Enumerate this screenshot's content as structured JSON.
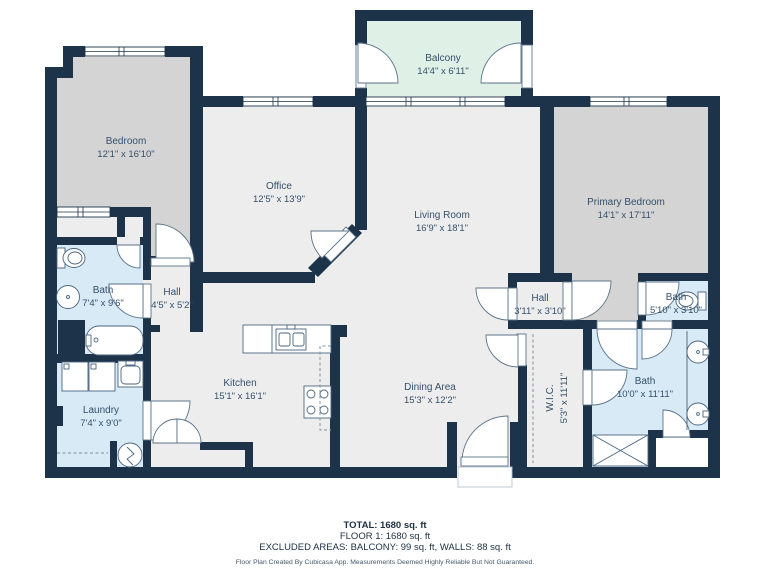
{
  "title": "Floor plan",
  "colors": {
    "wall": "#1d3349",
    "floor": "#ededed",
    "bedroom_floor": "#d4d4d4",
    "bath_floor": "#d7eaf6",
    "balcony_floor": "#dff1e6",
    "label_text": "#35506b"
  },
  "rooms": {
    "balcony": {
      "name": "Balcony",
      "dims": "14'4\" x 6'11\""
    },
    "bedroom": {
      "name": "Bedroom",
      "dims": "12'1\" x 16'10\""
    },
    "office": {
      "name": "Office",
      "dims": "12'5\" x 13'9\""
    },
    "living": {
      "name": "Living Room",
      "dims": "16'9\" x 18'1\""
    },
    "primary": {
      "name": "Primary Bedroom",
      "dims": "14'1\" x 17'11\""
    },
    "bath_left": {
      "name": "Bath",
      "dims": "7'4\" x 9'6\""
    },
    "hall_left": {
      "name": "Hall",
      "dims": "4'5\" x 5'2\""
    },
    "laundry": {
      "name": "Laundry",
      "dims": "7'4\" x 9'0\""
    },
    "kitchen": {
      "name": "Kitchen",
      "dims": "15'1\" x 16'1\""
    },
    "dining": {
      "name": "Dining Area",
      "dims": "15'3\" x 12'2\""
    },
    "hall_right": {
      "name": "Hall",
      "dims": "3'11\" x 3'10\""
    },
    "bath_small": {
      "name": "Bath",
      "dims": "5'10\" x 3'10\""
    },
    "wic": {
      "name": "W.I.C.",
      "dims": "5'3\" x 11'11\""
    },
    "bath_primary": {
      "name": "Bath",
      "dims": "10'0\" x 11'11\""
    }
  },
  "footer": {
    "total": "TOTAL: 1680 sq. ft",
    "floor": "FLOOR 1: 1680 sq. ft",
    "excluded": "EXCLUDED AREAS: BALCONY: 99 sq. ft, WALLS: 88 sq. ft",
    "disclaimer": "Floor Plan Created By Cubicasa App. Measurements Deemed Highly Reliable But Not Guaranteed."
  }
}
